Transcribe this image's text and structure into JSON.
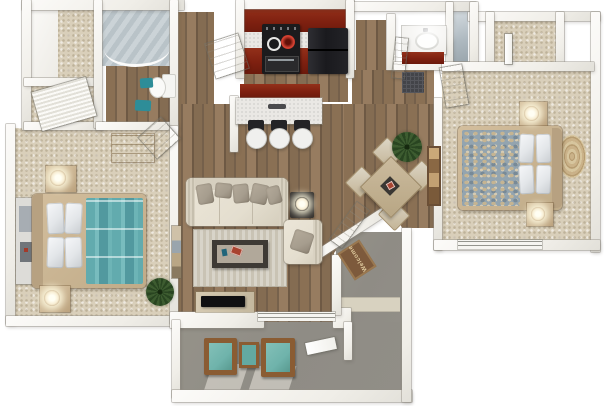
{
  "scene": {
    "type": "3d-floor-plan",
    "view": "top-down isometric render",
    "description": "Two-bedroom, two-bathroom apartment 3D floor plan with kitchen, breakfast bar, living/dining room, entry with welcome mat, and patio with lounge chairs"
  },
  "palette": {
    "wall": "#f0eee8",
    "carpet": "#d9cfba",
    "wood": "#8a7054",
    "brick": "#7e2010",
    "teal": "#62abae",
    "teal2": "#2e8d98",
    "tan": "#cdb795",
    "cream": "#e4decf",
    "taupe": "#a69d8e",
    "concrete": "#8f8c85",
    "rug": "#c9c3b4",
    "patio_teal": "#6fb3ab",
    "rattan": "#c9b086",
    "plant": "#3d5c30",
    "mat": "#7d5a3c",
    "appliance": "#1b1b1d"
  },
  "entry": {
    "welcome_mat_text": "Welcome"
  },
  "rooms": [
    {
      "name": "walk-in-closet",
      "floor": "carpet",
      "furniture": []
    },
    {
      "name": "hall-closet",
      "floor": "carpet",
      "furniture": [
        "louvered sliding door"
      ]
    },
    {
      "name": "bathroom-1",
      "floor": "wood",
      "furniture": [
        "tiled shower with curved glass",
        "toilet",
        "2 teal bath mats"
      ]
    },
    {
      "name": "master-bedroom",
      "floor": "carpet",
      "furniture": [
        "teal-striped queen bed with 4 white pillows",
        "2 nightstands with lit lamps",
        "side dresser",
        "tall dresser",
        "potted plant"
      ]
    },
    {
      "name": "kitchen",
      "floor": "wood",
      "furniture": [
        "dark red upper and lower cabinets",
        "black range with burners",
        "black refrigerator",
        "breakfast bar",
        "3 bar stools"
      ]
    },
    {
      "name": "living-room",
      "floor": "wood",
      "furniture": [
        "cream sofa with taupe pillows",
        "armchair",
        "side table with lamp",
        "dark coffee table",
        "area rug",
        "TV stand with flat TV",
        "wall art",
        "sliding glass door"
      ]
    },
    {
      "name": "dining-area",
      "floor": "wood",
      "furniture": [
        "square table with 4 chairs",
        "potted plant",
        "wall art"
      ]
    },
    {
      "name": "bathroom-2",
      "floor": "tile",
      "furniture": [
        "vanity with sink and red cabinet",
        "glass shower",
        "dark floor mat"
      ]
    },
    {
      "name": "bedroom-2",
      "floor": "carpet",
      "furniture": [
        "patterned queen bed with 4 white pillows",
        "2 nightstands with lit lamps",
        "round jute rug",
        "closet with door",
        "window"
      ]
    },
    {
      "name": "entry",
      "floor": "concrete",
      "furniture": [
        "open front door",
        "welcome mat"
      ]
    },
    {
      "name": "patio",
      "floor": "concrete",
      "furniture": [
        "2 teal lounge chairs",
        "teal side table",
        "patio door"
      ]
    }
  ]
}
